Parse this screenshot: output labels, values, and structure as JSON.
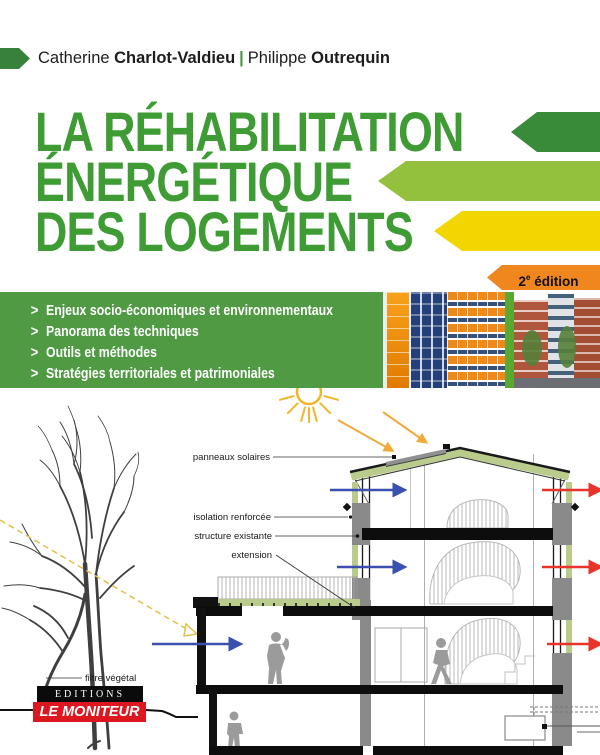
{
  "header": {
    "author1_first": "Catherine",
    "author1_last": "Charlot-Valdieu",
    "separator": "|",
    "author2_first": "Philippe",
    "author2_last": "Outrequin"
  },
  "title": {
    "line1": "LA RÉHABILITATION",
    "line2": "ÉNERGÉTIQUE",
    "line3": "DES LOGEMENTS"
  },
  "edition": {
    "number": "2",
    "superscript": "e",
    "word": "édition"
  },
  "topics": {
    "bullet": ">",
    "items": [
      "Enjeux socio-économiques et environnementaux",
      "Panorama des techniques",
      "Outils et méthodes",
      "Stratégies territoriales et patrimoniales"
    ]
  },
  "diagram": {
    "labels": {
      "solar_panels": "panneaux solaires",
      "insulation": "isolation renforcée",
      "structure": "structure existante",
      "extension": "extension",
      "vegetal_filter": "filtre végétal"
    }
  },
  "publisher": {
    "imprint": "EDITIONS",
    "name": "LE MONITEUR"
  },
  "colors": {
    "title_green": "#3f9c35",
    "arrow_dark_green": "#3a8b39",
    "arrow_light_green": "#94c13d",
    "arrow_yellow": "#f2d602",
    "badge_orange": "#ef861e",
    "band_green": "#4f9a43",
    "author_arrow_green": "#37813a",
    "insulation_green": "#b9cc8c",
    "flow_in_blue": "#3a4fae",
    "flow_out_red": "#e8342a",
    "sun_yellow": "#f0b62a",
    "logo_red": "#dd1720"
  }
}
